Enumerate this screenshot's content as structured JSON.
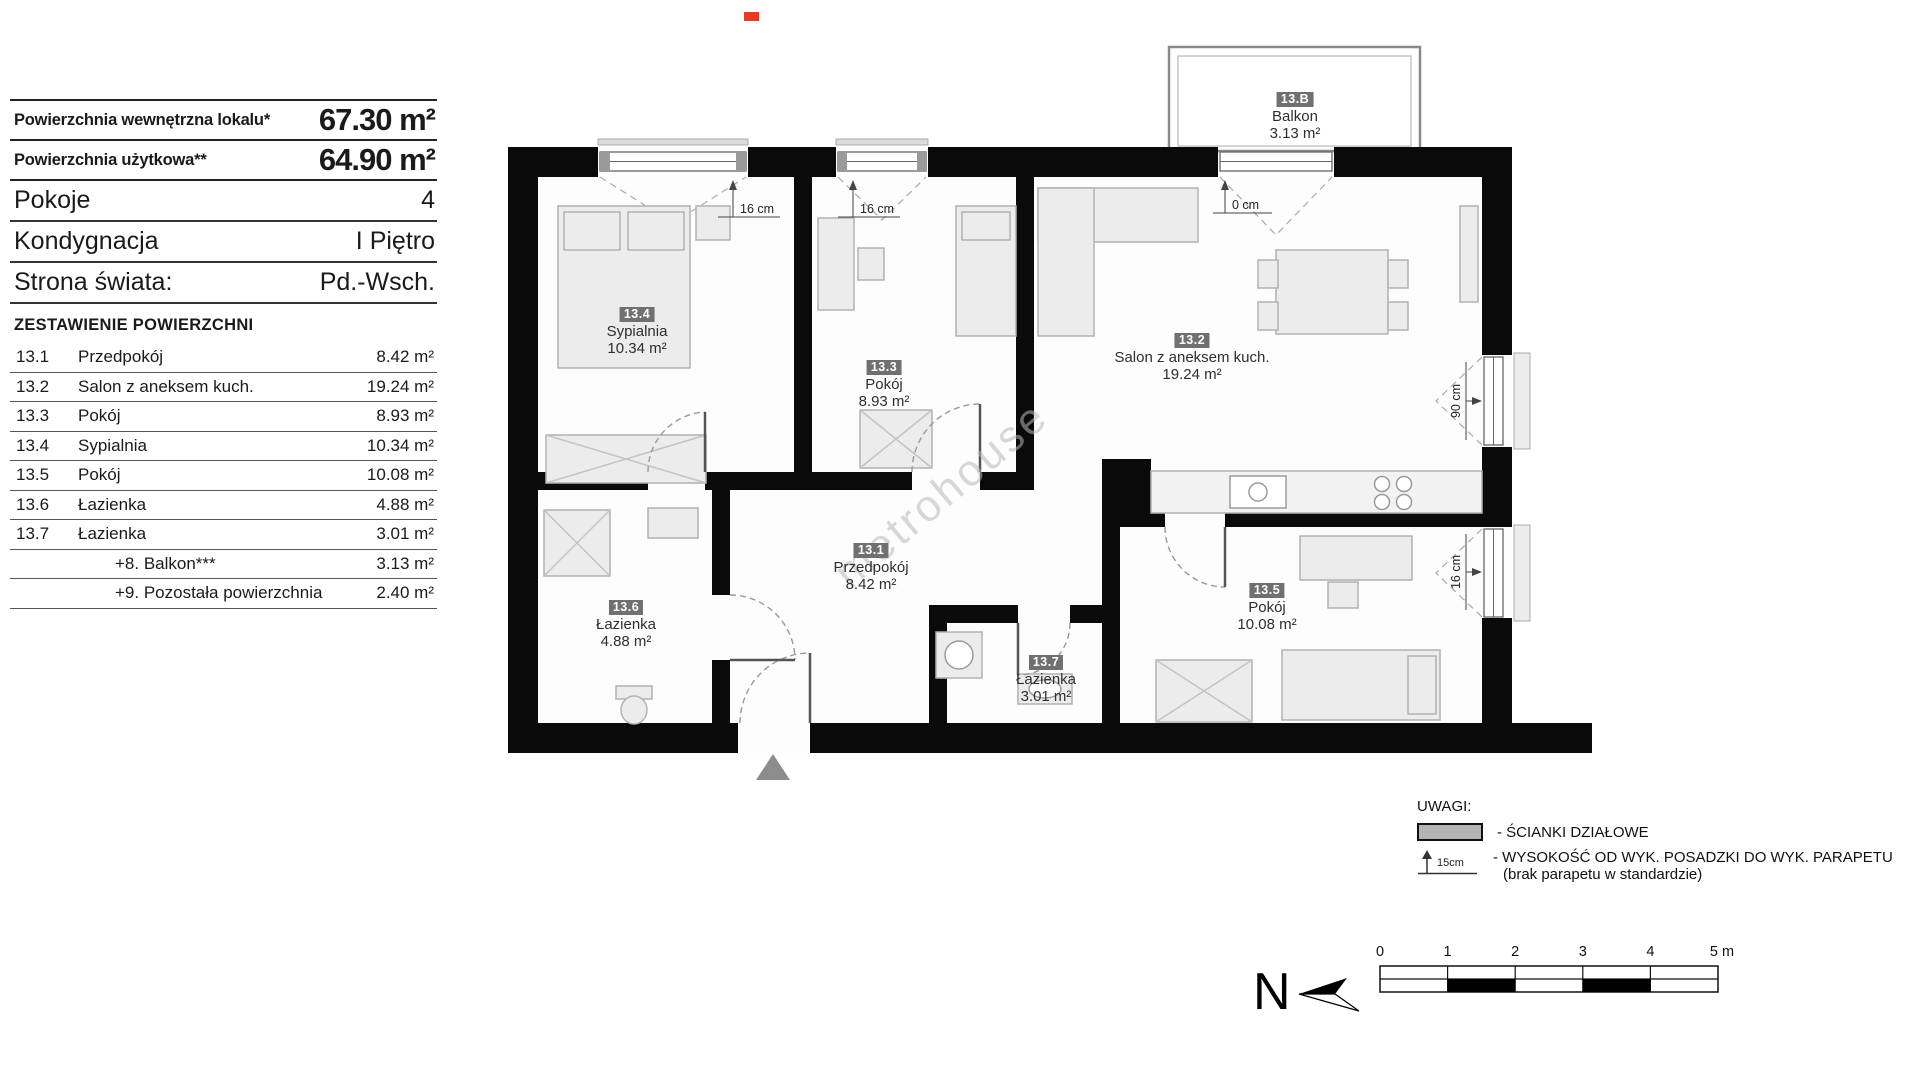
{
  "info_panel": {
    "rows_top": [
      {
        "label": "Powierzchnia wewnętrzna lokalu*",
        "value": "67.30 m²"
      },
      {
        "label": "Powierzchnia użytkowa**",
        "value": "64.90 m²"
      }
    ],
    "rows_mid": [
      {
        "label": "Pokoje",
        "value": "4"
      },
      {
        "label": "Kondygnacja",
        "value": "I Piętro"
      },
      {
        "label": "Strona świata:",
        "value": "Pd.-Wsch."
      }
    ],
    "list_title": "ZESTAWIENIE POWIERZCHNI",
    "list": [
      {
        "no": "13.1",
        "name": "Przedpokój",
        "area": "8.42 m²"
      },
      {
        "no": "13.2",
        "name": "Salon z aneksem kuch.",
        "area": "19.24 m²"
      },
      {
        "no": "13.3",
        "name": "Pokój",
        "area": "8.93 m²"
      },
      {
        "no": "13.4",
        "name": "Sypialnia",
        "area": "10.34 m²"
      },
      {
        "no": "13.5",
        "name": "Pokój",
        "area": "10.08 m²"
      },
      {
        "no": "13.6",
        "name": "Łazienka",
        "area": "4.88 m²"
      },
      {
        "no": "13.7",
        "name": "Łazienka",
        "area": "3.01 m²"
      },
      {
        "no": "",
        "name": "+8. Balkon***",
        "area": "3.13 m²"
      },
      {
        "no": "",
        "name": "+9. Pozostała powierzchnia",
        "area": "2.40 m²"
      }
    ]
  },
  "plan": {
    "rooms": [
      {
        "id": "13.B",
        "name": "Balkon",
        "area": "3.13 m²"
      },
      {
        "id": "13.4",
        "name": "Sypialnia",
        "area": "10.34 m²"
      },
      {
        "id": "13.3",
        "name": "Pokój",
        "area": "8.93 m²"
      },
      {
        "id": "13.2",
        "name": "Salon z aneksem kuch.",
        "area": "19.24 m²"
      },
      {
        "id": "13.1",
        "name": "Przedpokój",
        "area": "8.42 m²"
      },
      {
        "id": "13.6",
        "name": "Łazienka",
        "area": "4.88 m²"
      },
      {
        "id": "13.7",
        "name": "Łazienka",
        "area": "3.01 m²"
      },
      {
        "id": "13.5",
        "name": "Pokój",
        "area": "10.08 m²"
      }
    ],
    "dims": {
      "w1": "16 cm",
      "w2": "16 cm",
      "balcony_door": "0 cm",
      "r1": "90 cm",
      "r2": "16 cm"
    },
    "watermark": "metrohouse"
  },
  "legend": {
    "title": "UWAGI:",
    "partition_label": "- ŚCIANKI DZIAŁOWE",
    "height_symbol_label": "15cm",
    "height_label_line1": "- WYSOKOŚĆ OD WYK. POSADZKI DO WYK. PARAPETU",
    "height_label_line2": "(brak parapetu w standardzie)"
  },
  "compass": {
    "label": "N"
  },
  "scale_bar": {
    "ticks": [
      "0",
      "1",
      "2",
      "3",
      "4",
      "5 m"
    ]
  }
}
